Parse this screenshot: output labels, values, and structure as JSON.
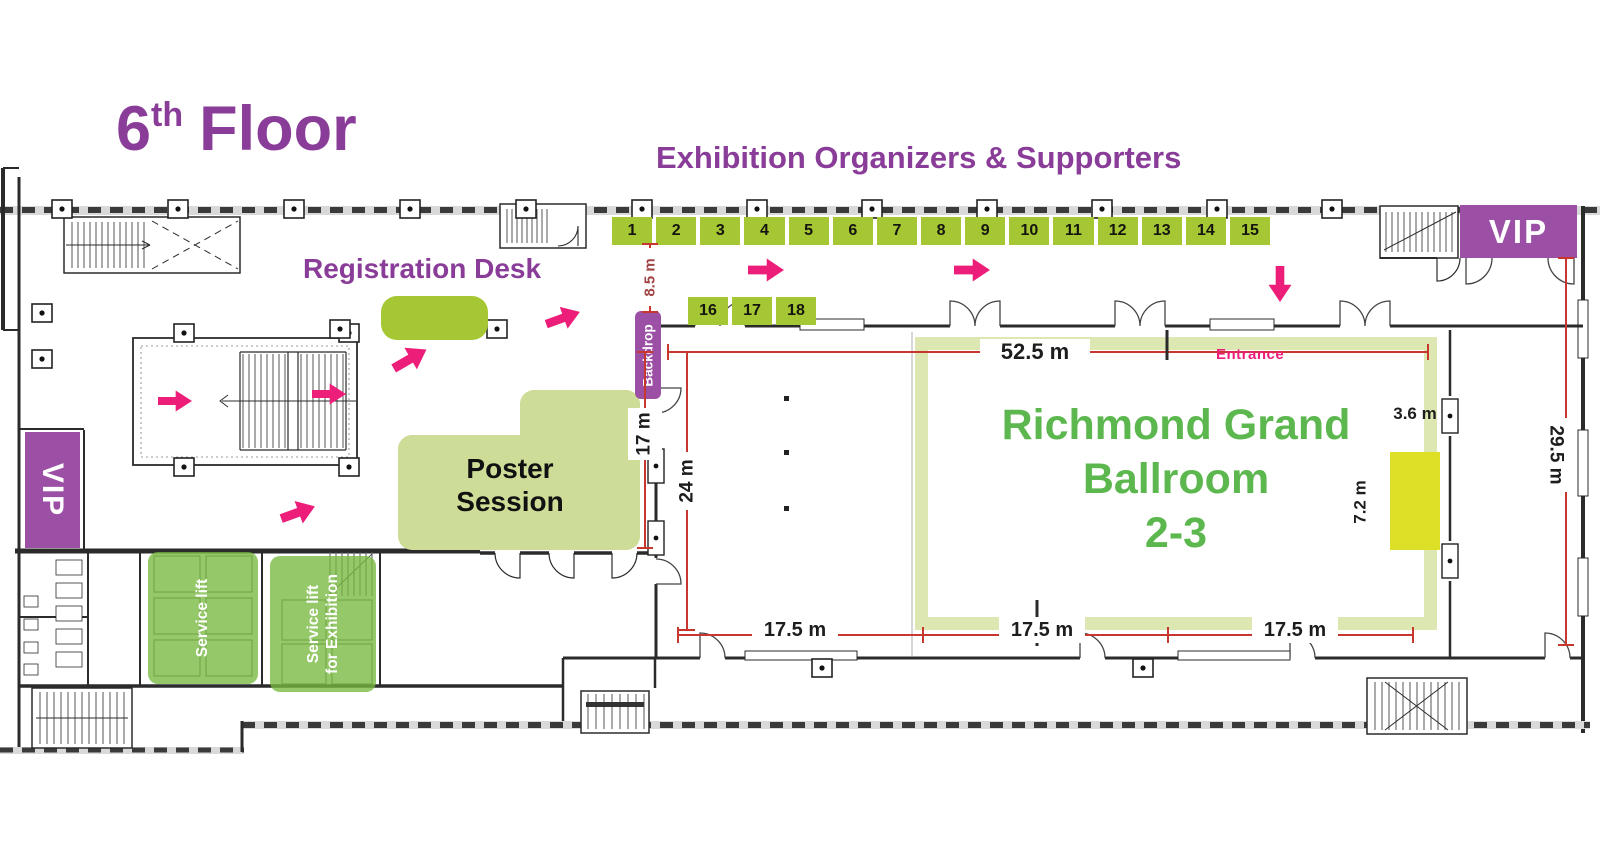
{
  "title": {
    "number": "6",
    "ordinal": "th",
    "word": "Floor"
  },
  "labels": {
    "exhibition_heading": "Exhibition Organizers & Supporters",
    "registration_desk": "Registration Desk",
    "poster_line1": "Poster",
    "poster_line2": "Session",
    "ballroom_line1": "Richmond Grand",
    "ballroom_line2": "Ballroom",
    "ballroom_line3": "2-3",
    "entrance": "Entrance",
    "backdrop": "Backdrop",
    "vip_left": "VIP",
    "vip_right": "VIP",
    "service_lift": "Service lift",
    "service_lift_exh_line1": "Service lift",
    "service_lift_exh_line2": "for Exhibition"
  },
  "booths": {
    "top_row": [
      "1",
      "2",
      "3",
      "4",
      "5",
      "6",
      "7",
      "8",
      "9",
      "10",
      "11",
      "12",
      "13",
      "14",
      "15"
    ],
    "inner_row": [
      "16",
      "17",
      "18"
    ]
  },
  "dimensions": {
    "backdrop_span": "8.5 m",
    "foyer_width": "17 m",
    "hall_width": "24 m",
    "ballroom_length": "52.5 m",
    "right_wing_length": "29.5 m",
    "stage_width": "3.6 m",
    "stage_depth": "7.2 m",
    "bays": [
      "17.5 m",
      "17.5 m",
      "17.5 m"
    ]
  },
  "colors": {
    "purple_heading": "#8a3d98",
    "purple_box": "#9b4fa5",
    "booth_green": "#a5c733",
    "poster_green": "#cddc96",
    "ballroom_frame_green": "#dce7b2",
    "service_lift_green": "#76b83e",
    "stage_yellow": "#dde026",
    "accent_pink": "#ed1e79",
    "dimension_red": "#c8372d",
    "ballroom_text_green": "#5cb84e",
    "dim_text_dark_red": "#a04444"
  }
}
